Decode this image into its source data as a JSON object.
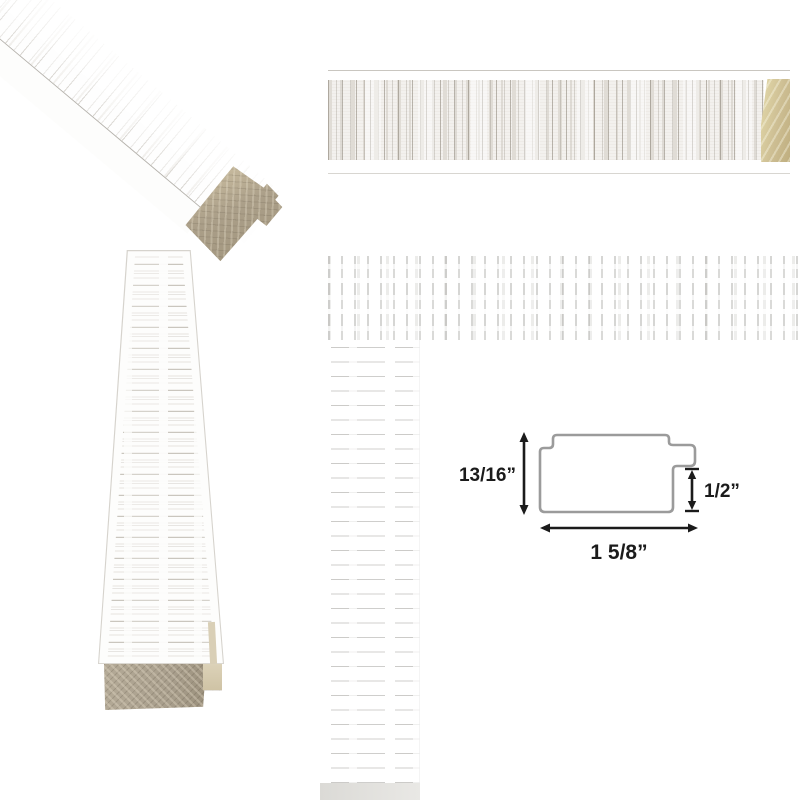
{
  "diagram": {
    "height_label": "13/16”",
    "rabbet_label": "1/2”",
    "width_label": "1 5/8”"
  },
  "colors": {
    "background": "#ffffff",
    "outline": "#9b9b9b",
    "dimension_ink": "#1b1b1b",
    "wood_cut": "#cdbe93",
    "wood_cut_dark": "#a1967f",
    "wood_cut_gray": "#a89e8c",
    "texture_streak": "#8d8577"
  }
}
